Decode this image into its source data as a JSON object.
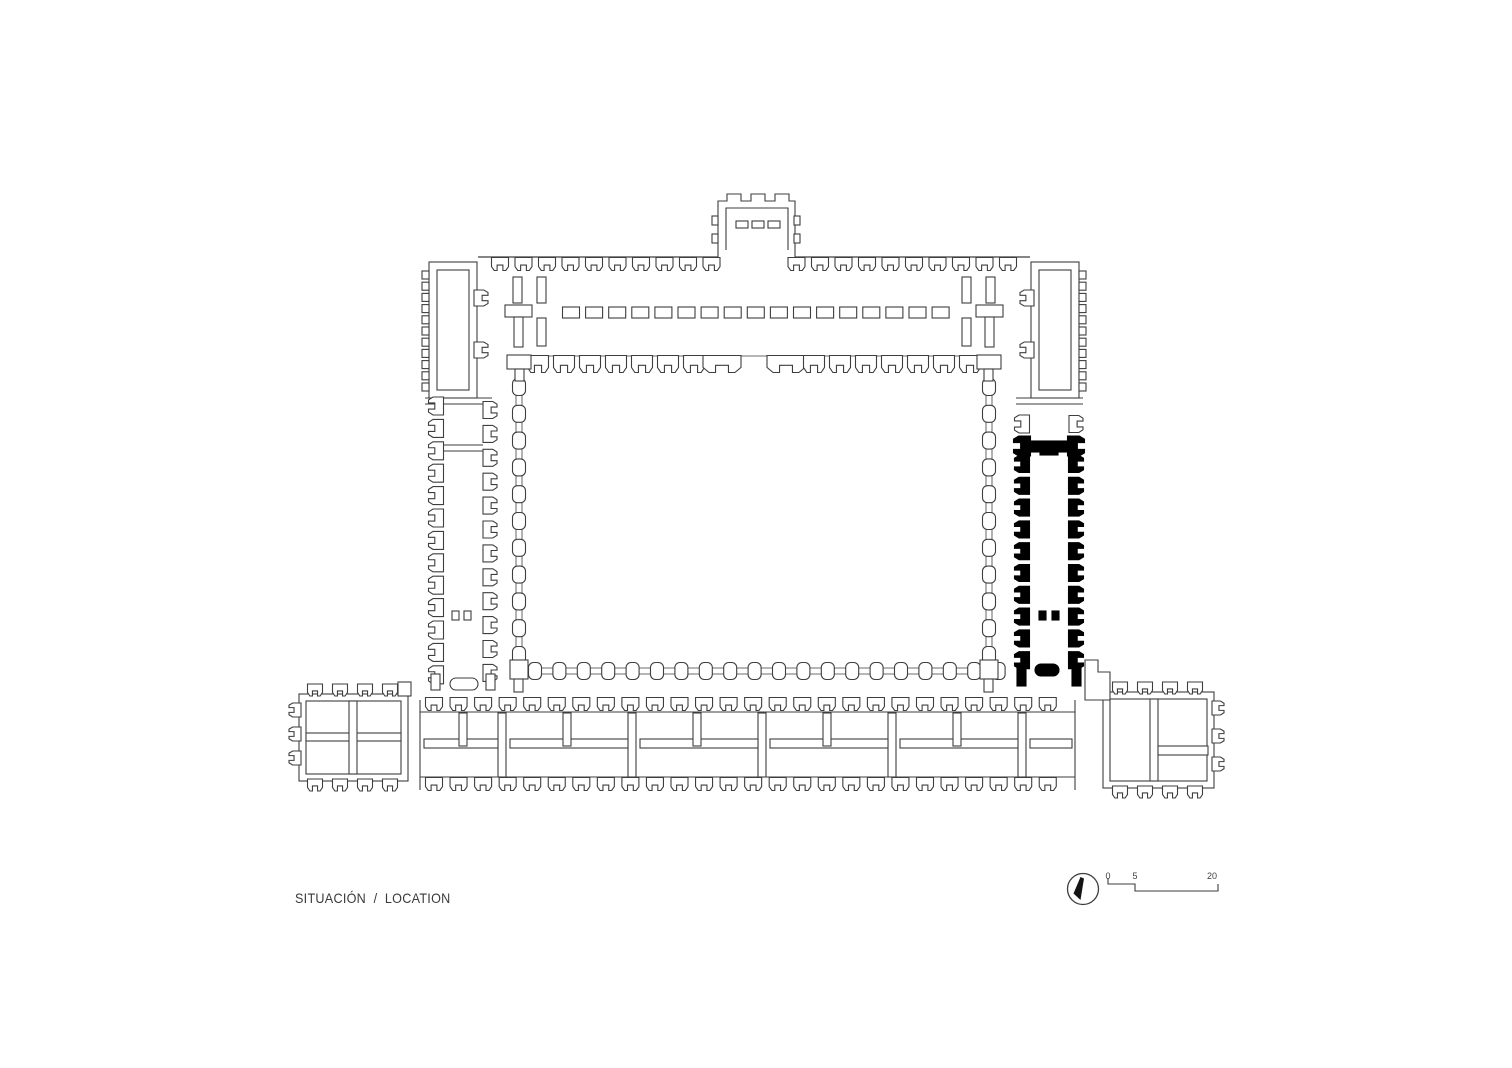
{
  "sheet": {
    "background": "#ffffff"
  },
  "caption": {
    "text": "SITUACIÓN  /  LOCATION"
  },
  "scale_bar": {
    "labels": [
      "0",
      "5",
      "20"
    ]
  },
  "icons": {
    "north_arrow": "north-arrow-icon"
  },
  "colors": {
    "line": "#3e3e3e",
    "highlight": "#000000"
  }
}
